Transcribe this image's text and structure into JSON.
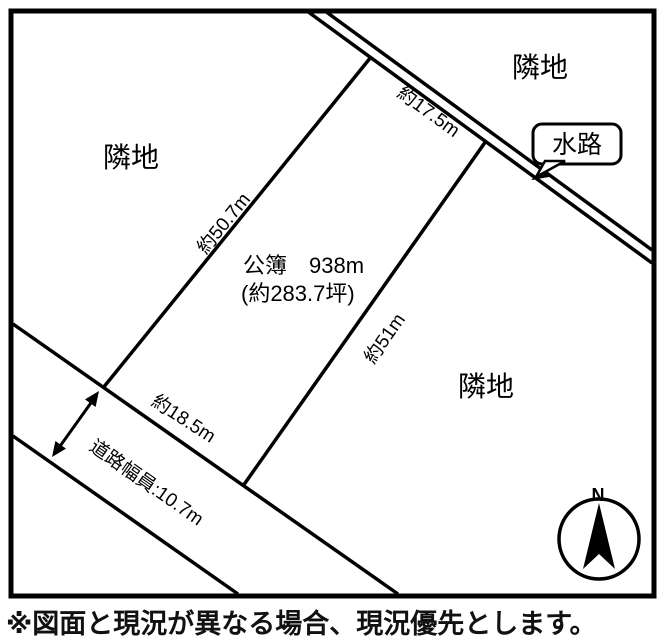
{
  "diagram": {
    "neighbors": {
      "top_left": "隣地",
      "top_right": "隣地",
      "bottom_right": "隣地"
    },
    "waterway_label": "水路",
    "dimensions": {
      "top": "約17.5m",
      "left": "約50.7m",
      "right": "約51m",
      "bottom": "約18.5m"
    },
    "road_width_label": "道路幅員:10.7m",
    "area": {
      "line1": "公簿　938m",
      "line2": "(約283.7坪)"
    },
    "compass": {
      "north": "N"
    }
  },
  "caption": "※図面と現況が異なる場合、現況優先とします。",
  "colors": {
    "line": "#000000",
    "background": "#ffffff"
  }
}
